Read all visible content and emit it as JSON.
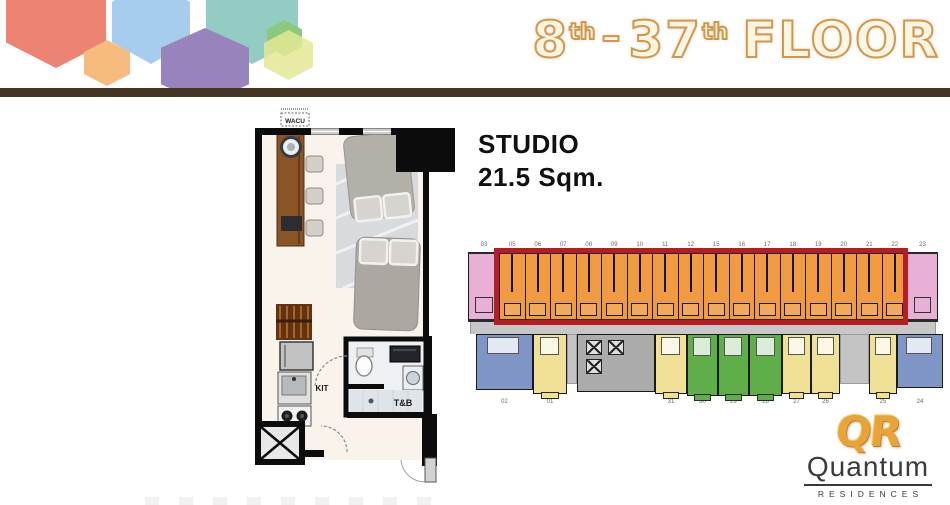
{
  "header": {
    "bar_color": "#473524",
    "hexagons": [
      {
        "name": "coral",
        "color": "#ED8372"
      },
      {
        "name": "sky",
        "color": "#A6CDED"
      },
      {
        "name": "teal",
        "color": "#93CCC2"
      },
      {
        "name": "orange",
        "color": "#F6BB7D"
      },
      {
        "name": "purple",
        "color": "#9883BC"
      },
      {
        "name": "green",
        "color": "#8BC97E"
      },
      {
        "name": "lime",
        "color": "#E3E893"
      }
    ],
    "title": {
      "n1": "8",
      "sup1": "th",
      "dash": "–",
      "n2": "37",
      "sup2": "th",
      "word": "FLOOR"
    }
  },
  "unit_info": {
    "type": "STUDIO",
    "area": "21.5 Sqm."
  },
  "floor_plan": {
    "labels": {
      "ac": "WACU",
      "kitchen": "KIT",
      "bath": "T&B"
    }
  },
  "floor_plate": {
    "highlight_color": "#B51E24",
    "unit_colors": {
      "orange": "#F09A41",
      "pink": "#E8B0D4",
      "blue": "#7E95C6",
      "yellow": "#F0E096",
      "green": "#5FAE4A",
      "core": "#ABABAB",
      "gap": "#C4C4C4"
    },
    "top_units": [
      {
        "no": "03",
        "type": "pink"
      },
      {
        "no": "05",
        "type": "orange"
      },
      {
        "no": "06",
        "type": "orange"
      },
      {
        "no": "07",
        "type": "orange"
      },
      {
        "no": "08",
        "type": "orange"
      },
      {
        "no": "09",
        "type": "orange"
      },
      {
        "no": "10",
        "type": "orange"
      },
      {
        "no": "11",
        "type": "orange"
      },
      {
        "no": "12",
        "type": "orange"
      },
      {
        "no": "15",
        "type": "orange"
      },
      {
        "no": "16",
        "type": "orange"
      },
      {
        "no": "17",
        "type": "orange"
      },
      {
        "no": "18",
        "type": "orange"
      },
      {
        "no": "19",
        "type": "orange"
      },
      {
        "no": "20",
        "type": "orange"
      },
      {
        "no": "21",
        "type": "orange"
      },
      {
        "no": "22",
        "type": "orange"
      },
      {
        "no": "23",
        "type": "pink"
      }
    ],
    "bottom_units": [
      {
        "no": "02",
        "type": "blue",
        "w": 57,
        "h": 56
      },
      {
        "no": "01",
        "type": "yellow",
        "w": 34,
        "h": 60
      },
      {
        "type": "gap",
        "w": 10,
        "h": 50
      },
      {
        "type": "core",
        "w": 78,
        "h": 58
      },
      {
        "no": "31",
        "type": "yellow",
        "w": 32,
        "h": 60
      },
      {
        "no": "30",
        "type": "green",
        "w": 31,
        "h": 62
      },
      {
        "no": "29",
        "type": "green",
        "w": 31,
        "h": 62
      },
      {
        "no": "28",
        "type": "green",
        "w": 33,
        "h": 62
      },
      {
        "no": "27",
        "type": "yellow",
        "w": 29,
        "h": 60
      },
      {
        "no": "26",
        "type": "yellow",
        "w": 29,
        "h": 60
      },
      {
        "type": "gap",
        "w": 29,
        "h": 50
      },
      {
        "no": "25",
        "type": "yellow",
        "w": 28,
        "h": 60
      },
      {
        "no": "24",
        "type": "blue",
        "w": 46,
        "h": 54
      }
    ]
  },
  "logo": {
    "monogram": "QR",
    "name": "Quantum",
    "subtitle": "RESIDENCES"
  }
}
